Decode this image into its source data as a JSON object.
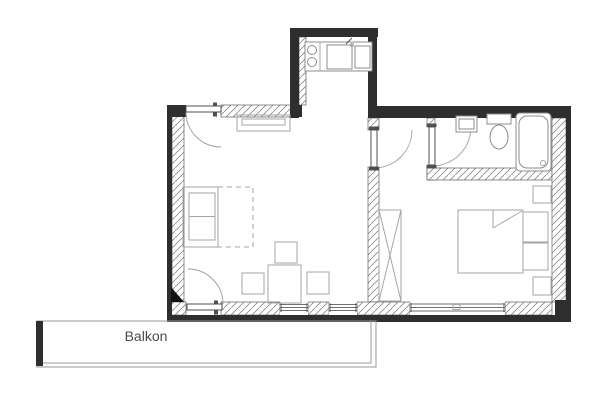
{
  "balcony": {
    "label": "Balkon"
  },
  "colors": {
    "background": "#ffffff",
    "wall": "#2e2e2e",
    "wall_hatch_line": "#8f8f8f",
    "wall_outline": "#5f5f5f",
    "furniture_outline": "#a6a6a6",
    "fixture_outline": "#8c8c8c",
    "door_leaf": "#4f4f4f",
    "door_arc": "#9e9e9e",
    "label_text": "#4a4a4a",
    "marker": "#111111"
  },
  "elements": {
    "rooms": [
      "living-room",
      "bedroom",
      "bathroom",
      "kitchen-niche",
      "balcony"
    ],
    "furniture": [
      "sofa",
      "sofa-bed-extension",
      "dining-table",
      "dining-chairs",
      "radiator",
      "wardrobe",
      "double-bed",
      "pillows",
      "nightstands"
    ],
    "kitchen_fixtures": [
      "cooktop-burners",
      "double-sink",
      "faucet"
    ],
    "bathroom_fixtures": [
      "washbasin",
      "toilet",
      "bathtub"
    ],
    "doors": [
      "entry-door",
      "bedroom-door",
      "bathroom-door",
      "balcony-door"
    ],
    "windows": [
      "living-window-1",
      "living-window-2",
      "bedroom-window"
    ]
  }
}
